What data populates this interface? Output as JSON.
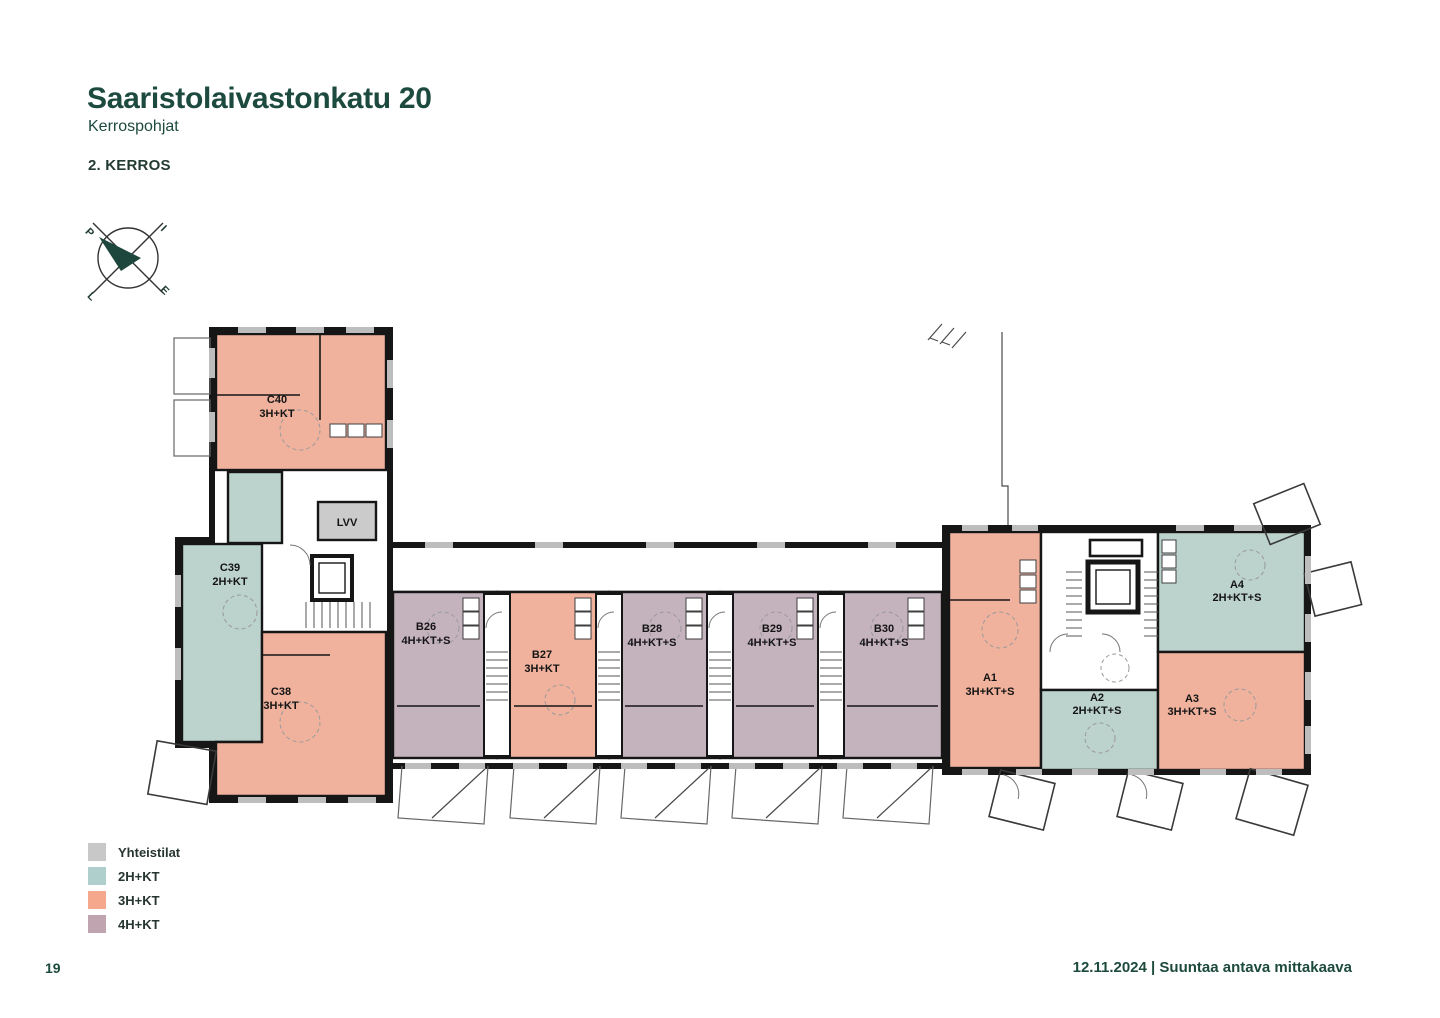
{
  "header": {
    "title": "Saaristolaivastonkatu 20",
    "subtitle": "Kerrospohjat",
    "floor_label": "2. KERROS"
  },
  "compass": {
    "north": "P",
    "east": "I",
    "south": "E",
    "west": "L"
  },
  "colors": {
    "legend": {
      "common": "#c8c8c8",
      "two_room": "#aecfcb",
      "three_room": "#f6a88c",
      "four_room": "#c0a4b0"
    },
    "plan": {
      "common": "#cbcbcb",
      "two_room": "#bcd2cc",
      "three_room": "#f0b29d",
      "four_room": "#c4b2bd"
    }
  },
  "plan": {
    "common_room_label": "LVV",
    "units": [
      {
        "id": "C40",
        "type": "3H+KT"
      },
      {
        "id": "C39",
        "type": "2H+KT"
      },
      {
        "id": "C38",
        "type": "3H+KT"
      },
      {
        "id": "B26",
        "type": "4H+KT+S"
      },
      {
        "id": "B27",
        "type": "3H+KT"
      },
      {
        "id": "B28",
        "type": "4H+KT+S"
      },
      {
        "id": "B29",
        "type": "4H+KT+S"
      },
      {
        "id": "B30",
        "type": "4H+KT+S"
      },
      {
        "id": "A1",
        "type": "3H+KT+S"
      },
      {
        "id": "A2",
        "type": "2H+KT+S"
      },
      {
        "id": "A3",
        "type": "3H+KT+S"
      },
      {
        "id": "A4",
        "type": "2H+KT+S"
      }
    ]
  },
  "legend": {
    "items": [
      {
        "label": "Yhteistilat"
      },
      {
        "label": "2H+KT"
      },
      {
        "label": "3H+KT"
      },
      {
        "label": "4H+KT"
      }
    ]
  },
  "footer": {
    "page_number": "19",
    "note": "12.11.2024 | Suuntaa antava mittakaava"
  }
}
